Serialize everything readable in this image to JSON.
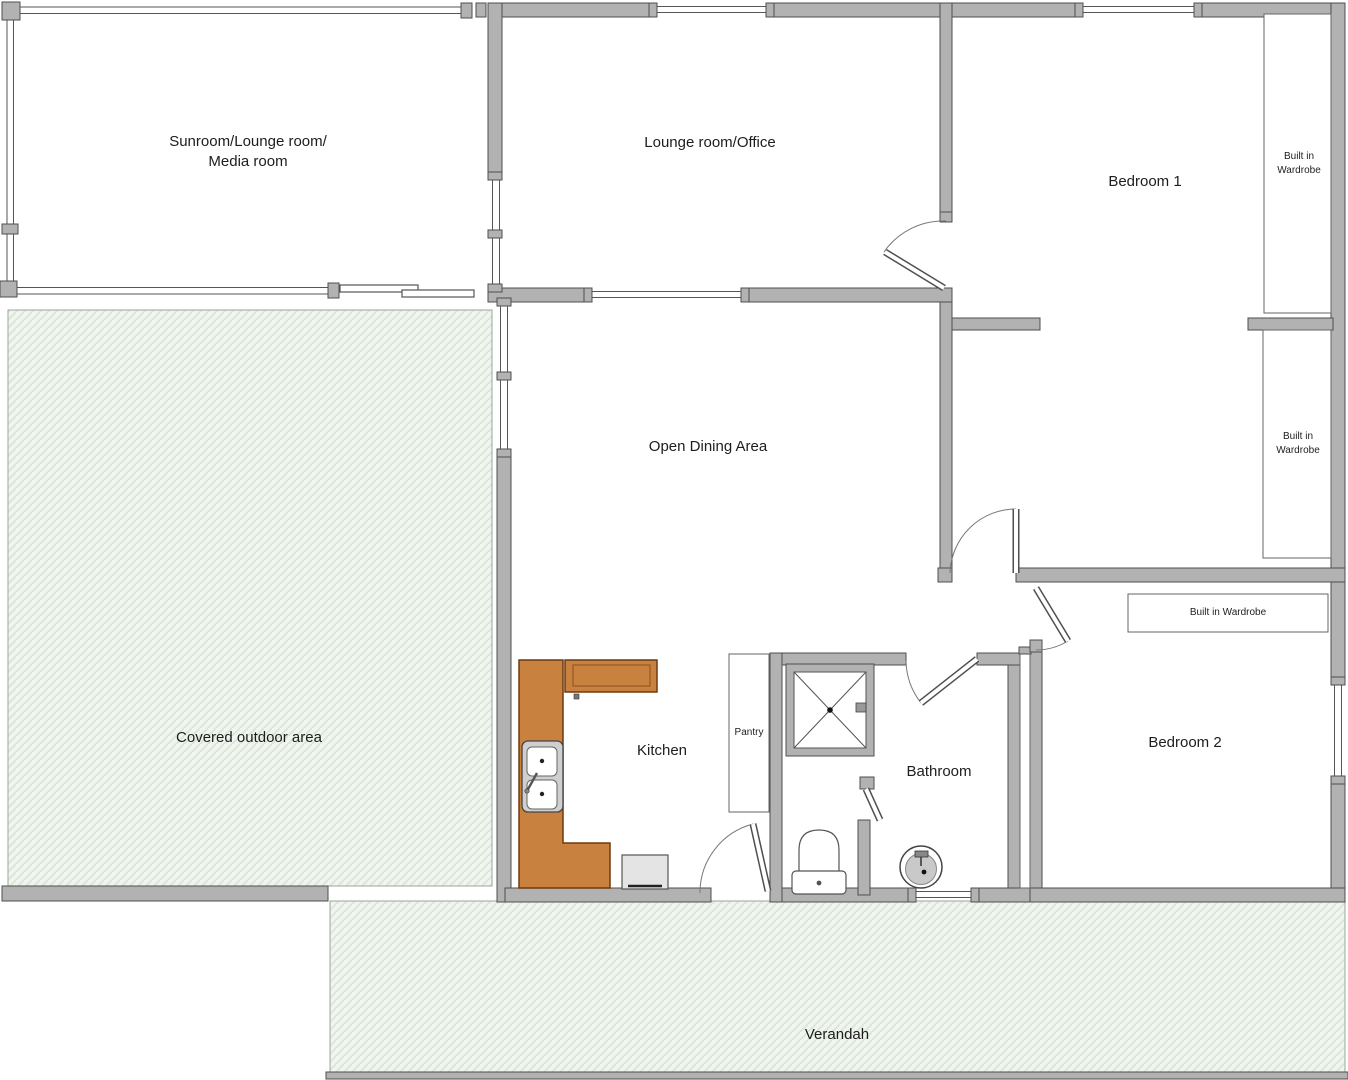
{
  "document_type": "floor-plan",
  "rooms": {
    "sunroom": {
      "label_line1": "Sunroom/Lounge room/",
      "label_line2": "Media room"
    },
    "lounge_office": {
      "label": "Lounge room/Office"
    },
    "bedroom1": {
      "label": "Bedroom 1"
    },
    "wardrobe1": {
      "label_line1": "Built in",
      "label_line2": "Wardrobe"
    },
    "wardrobe2": {
      "label_line1": "Built in",
      "label_line2": "Wardrobe"
    },
    "dining": {
      "label": "Open Dining Area"
    },
    "covered_outdoor": {
      "label": "Covered outdoor area"
    },
    "kitchen": {
      "label": "Kitchen"
    },
    "pantry": {
      "label": "Pantry"
    },
    "bathroom": {
      "label": "Bathroom"
    },
    "bedroom2": {
      "label": "Bedroom 2"
    },
    "wardrobe3": {
      "label": "Built in Wardrobe"
    },
    "verandah": {
      "label": "Verandah"
    }
  },
  "fixtures": [
    "kitchen-counter",
    "overhead-cabinet",
    "double-sink",
    "stove-appliance",
    "pantry-cupboard",
    "shower",
    "toilet",
    "round-basin",
    "built-in-wardrobe-1",
    "built-in-wardrobe-2",
    "built-in-wardrobe-3",
    "sliding-door",
    "hinged-doors",
    "windows"
  ],
  "colors": {
    "wall_fill": "#b2b2b2",
    "wall_outline": "#4f4f4f",
    "hatch_bg": "#f1f5ef",
    "hatch_line": "#dde6d9",
    "counter_fill": "#c9813f",
    "counter_outline": "#6e3a10",
    "label_color": "#1d1d1d",
    "background": "#ffffff"
  }
}
